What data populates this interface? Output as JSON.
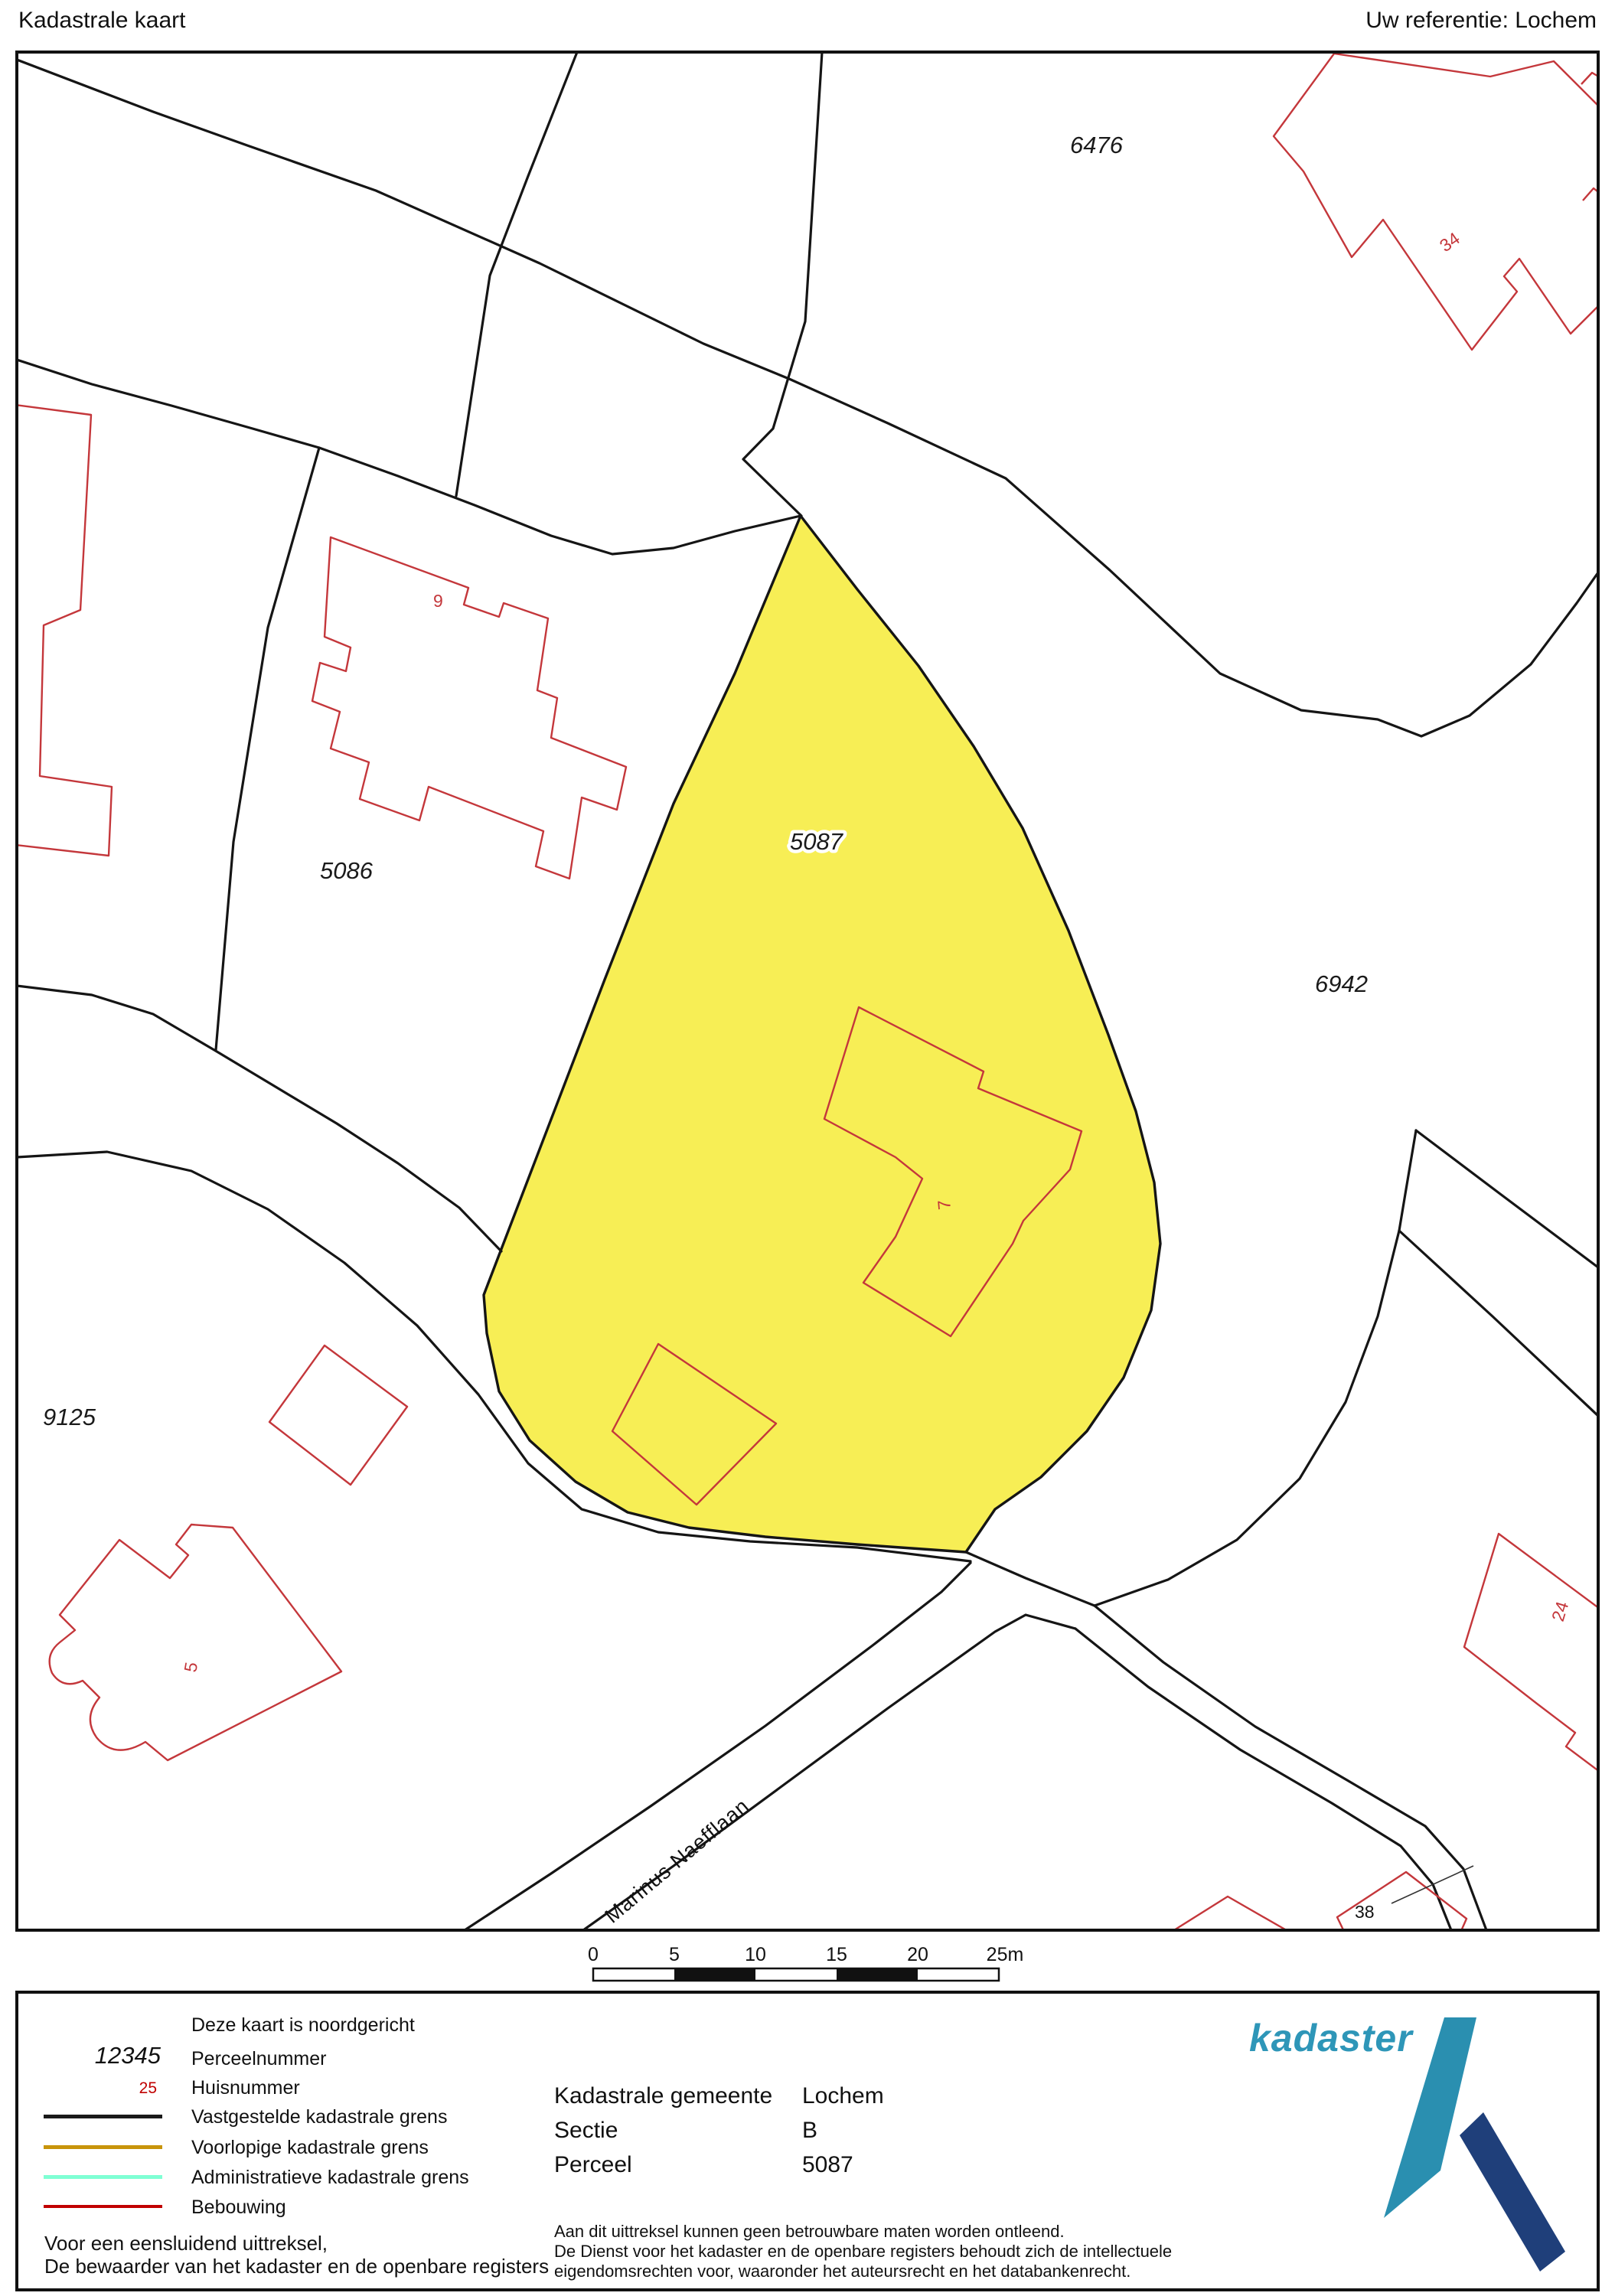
{
  "header": {
    "title": "Kadastrale kaart",
    "reference": "Uw referentie: Lochem"
  },
  "map": {
    "highlight_color": "#f7ee55",
    "building_color": "#c4373b",
    "boundary_color": "#151515",
    "parcels": [
      {
        "label": "6476"
      },
      {
        "label": "5086"
      },
      {
        "label": "5087",
        "highlighted": true
      },
      {
        "label": "6942"
      },
      {
        "label": "9125"
      }
    ],
    "house_numbers": [
      {
        "label": "9"
      },
      {
        "label": "34"
      },
      {
        "label": "7"
      },
      {
        "label": "5"
      },
      {
        "label": "24"
      },
      {
        "label": "38"
      }
    ],
    "street": {
      "name": "Marinus Naefflaan"
    },
    "scalebar": {
      "labels": [
        "0",
        "5",
        "10",
        "15",
        "20",
        "25m"
      ]
    }
  },
  "legend": {
    "north_note": "Deze kaart is noordgericht",
    "parcel_sample": "12345",
    "parcel_label": "Perceelnummer",
    "house_sample": "25",
    "house_label": "Huisnummer",
    "lines": [
      {
        "label": "Vastgestelde kadastrale grens",
        "color": "#1a1a1a"
      },
      {
        "label": "Voorlopige kadastrale grens",
        "color": "#c8940a"
      },
      {
        "label": "Administratieve kadastrale grens",
        "color": "#7fffd4"
      },
      {
        "label": "Bebouwing",
        "color": "#c00000"
      }
    ],
    "attest_line1": "Voor een eensluidend uittreksel,",
    "attest_line2": "De bewaarder van het kadaster en de openbare registers"
  },
  "details": {
    "rows": [
      {
        "label": "Kadastrale gemeente",
        "value": "Lochem"
      },
      {
        "label": "Sectie",
        "value": "B"
      },
      {
        "label": "Perceel",
        "value": "5087"
      }
    ],
    "disclaimer": [
      "Aan dit uittreksel kunnen geen betrouwbare maten worden ontleend.",
      "De Dienst voor het kadaster en de openbare registers behoudt zich de intellectuele",
      "eigendomsrechten voor, waaronder het auteursrecht en het databankenrecht."
    ]
  },
  "logo": {
    "text": "kadaster",
    "text_color": "#2e96b8",
    "blade_color": "#2a8fb0",
    "beam_color": "#1f3f7a"
  }
}
